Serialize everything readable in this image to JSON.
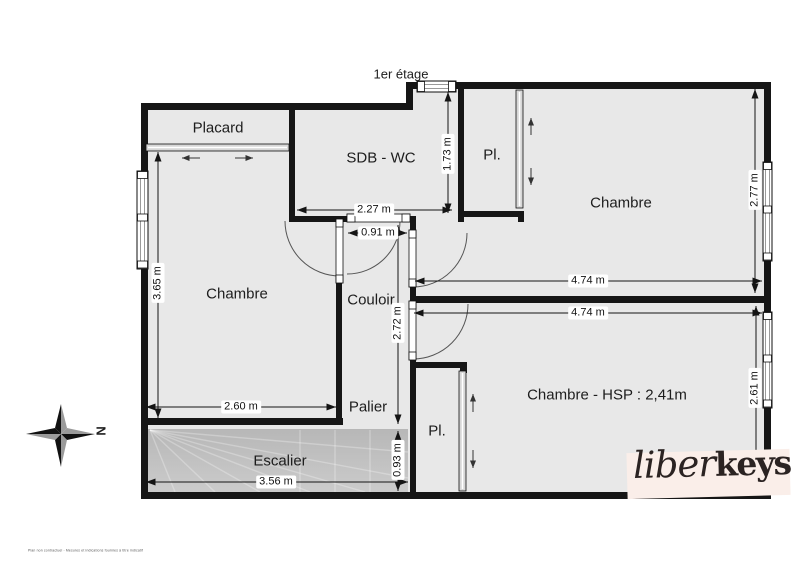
{
  "floor_title": "1er étage",
  "rooms": {
    "placard": "Placard",
    "sdb_wc": "SDB - WC",
    "pl_top": "Pl.",
    "chambre_top_right": "Chambre",
    "chambre_left": "Chambre",
    "couloir": "Couloir",
    "palier": "Palier",
    "escalier": "Escalier",
    "pl_bottom": "Pl.",
    "chambre_bottom_right": "Chambre - HSP : 2,41m"
  },
  "dims": {
    "sdb_width": "2.27 m",
    "sdb_height": "1.73 m",
    "couloir_door_width": "0.91 m",
    "chambre_top_height": "2.77 m",
    "chambre_top_width": "4.74 m",
    "chambre_bottom_width": "4.74 m",
    "chambre_left_height": "3.65 m",
    "chambre_left_width": "2.60 m",
    "couloir_height": "2.72 m",
    "chambre_bottom_height": "2.61 m",
    "escalier_height": "0.93 m",
    "escalier_width": "3.56 m"
  },
  "compass": {
    "north_label": "N"
  },
  "logo": {
    "script_part": "liber",
    "bold_part": "keys"
  },
  "footer_note": "Plan non contractuel - Mesures et indications fournies à titre indicatif",
  "colors": {
    "room_fill": "#e8e8e8",
    "wall": "#161616",
    "stairs_fill": "#c4c4c4",
    "logo_bg": "#faeee9",
    "logo_text": "#2b2322"
  }
}
